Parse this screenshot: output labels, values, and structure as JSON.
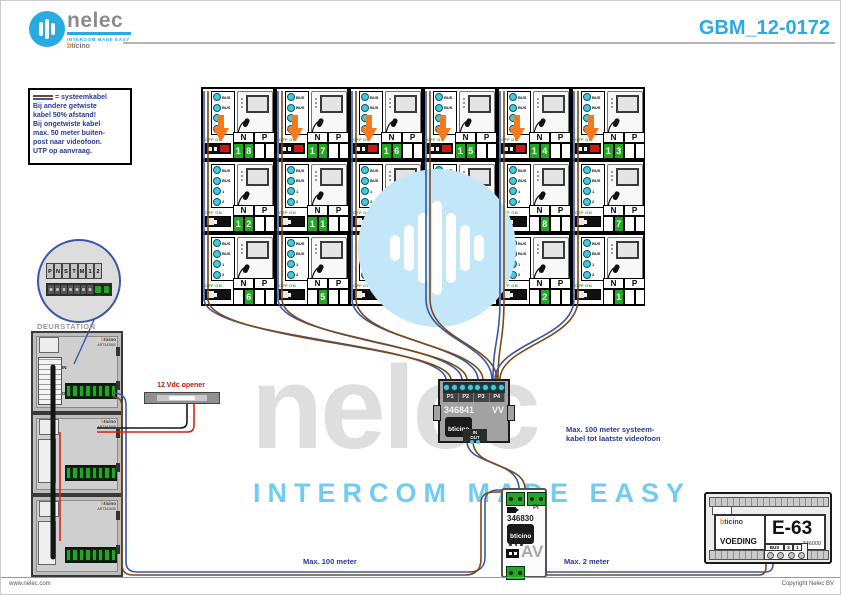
{
  "header": {
    "brand": "nelec",
    "tagline": "INTERCOM MADE EASY",
    "sub_brand": "bticino",
    "doc_number": "GBM_12-0172"
  },
  "note": {
    "legend": "= systeemkabel",
    "lines": [
      "Bij andere getwiste",
      "kabel 50% afstand!",
      "Bij ongetwiste kabel",
      "max. 50 meter buiten-",
      "post naar videofoon.",
      "UTP op aanvraag."
    ]
  },
  "grid": {
    "header_n": "N",
    "header_p": "P",
    "dip_label": "OFF ON",
    "terminal_labels": [
      "BUS",
      "BUS",
      "1",
      "2"
    ],
    "units": [
      {
        "n": "18"
      },
      {
        "n": "17"
      },
      {
        "n": "16"
      },
      {
        "n": "15"
      },
      {
        "n": "14"
      },
      {
        "n": "13"
      },
      {
        "n": "12"
      },
      {
        "n": "11"
      },
      {
        "n": "10"
      },
      {
        "n": "9"
      },
      {
        "n": "8"
      },
      {
        "n": "7"
      },
      {
        "n": "6"
      },
      {
        "n": "5"
      },
      {
        "n": "4"
      },
      {
        "n": "3"
      },
      {
        "n": "2"
      },
      {
        "n": "1"
      }
    ]
  },
  "door_station": {
    "label": "DEURSTATION",
    "in_label": "IN",
    "out_label": "OUT",
    "modules": [
      {
        "brand": "bticino",
        "art": "ART342560"
      },
      {
        "brand": "bticino",
        "art": "ART342600"
      },
      {
        "brand": "bticino",
        "art": "ART342600"
      }
    ],
    "detail_terminals": [
      "P",
      "N",
      "S",
      "T",
      "M",
      "1",
      "2"
    ]
  },
  "opener": {
    "label": "12 Vdc opener"
  },
  "distributor": {
    "model": "346841",
    "variant": "VV",
    "brand": "bticino",
    "ports": [
      "P1",
      "P2",
      "P3",
      "P4"
    ],
    "in_label": "IN",
    "out_label": "OUT"
  },
  "converter": {
    "model": "346830",
    "brand": "bticino",
    "pi_label": "PI",
    "av_label": "AV"
  },
  "power_supply": {
    "brand": "bticino",
    "name": "VOEDING",
    "model": "E-63",
    "part_number": "346000",
    "bus_labels": [
      "BUS",
      "2",
      "1"
    ]
  },
  "annotations": {
    "system_cable_line1": "Max. 100 meter systeem-",
    "system_cable_line2": "kabel tot laatste videofoon",
    "bottom_left": "Max. 100 meter",
    "bottom_right": "Max. 2 meter"
  },
  "watermark": {
    "name": "nelec",
    "tagline": "INTERCOM MADE EASY"
  },
  "footer": {
    "left": "www.nelec.com",
    "right": "Copyright Nelec BV"
  },
  "colors": {
    "accent": "#29ABE2",
    "navy": "#2B3990",
    "orange": "#F47A1F",
    "green": "#23A428",
    "wire_blue": "#3A55A8",
    "wire_brown": "#7A4A15",
    "wire_red": "#DD2211",
    "wire_black": "#161616"
  }
}
